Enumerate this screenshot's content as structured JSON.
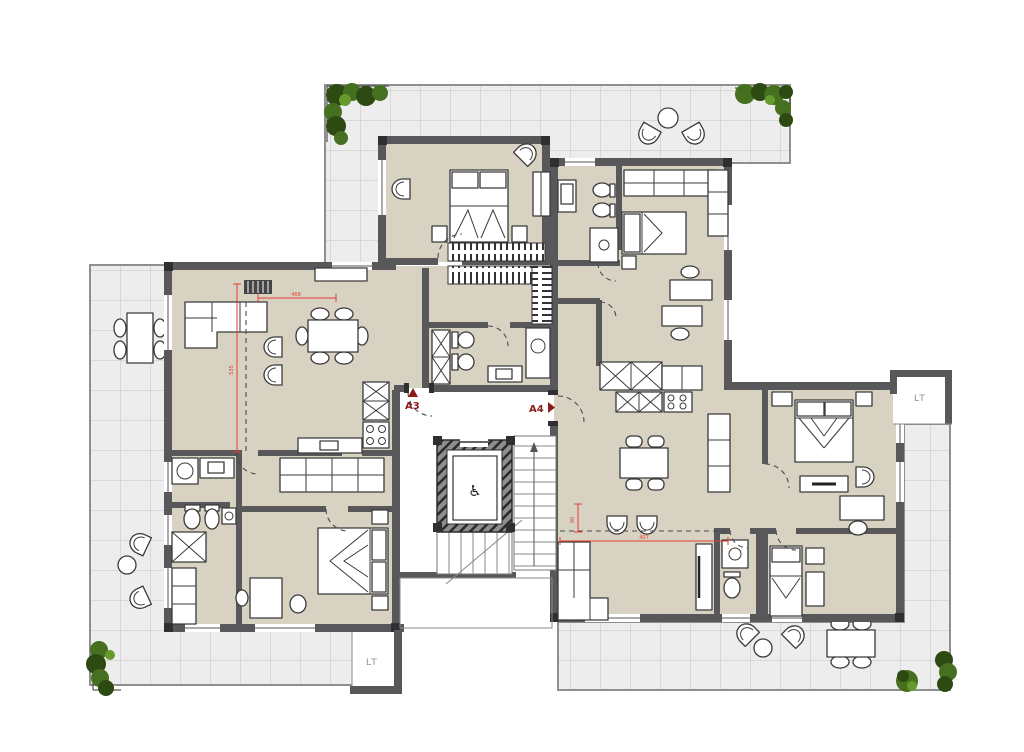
{
  "title": "Residential floor plan – units A3 and A4",
  "labels": {
    "unit_a3": "A3",
    "unit_a4": "A4",
    "lt_right": "LT",
    "lt_bottom": "LT",
    "accessibility_icon": "♿"
  },
  "dimensions": {
    "a3_room_width": "468",
    "a3_room_height": "535",
    "a4_room_width": "407",
    "a4_wall_offset": "90"
  },
  "colors": {
    "background": "#ffffff",
    "wall": "#58585a",
    "floor": "#d8d2c3",
    "terrace": "#ededed",
    "tile_line": "#c3c3c3",
    "terrace_edge": "#8f8f8f",
    "furniture_stroke": "#3a3a3a",
    "plant_dark": "#2c4a12",
    "plant_mid": "#457020",
    "plant_light": "#679a2c",
    "dim_red": "#e53c31",
    "unit_label_red": "#8c1d18",
    "lt_gray": "#8f8f9b"
  }
}
